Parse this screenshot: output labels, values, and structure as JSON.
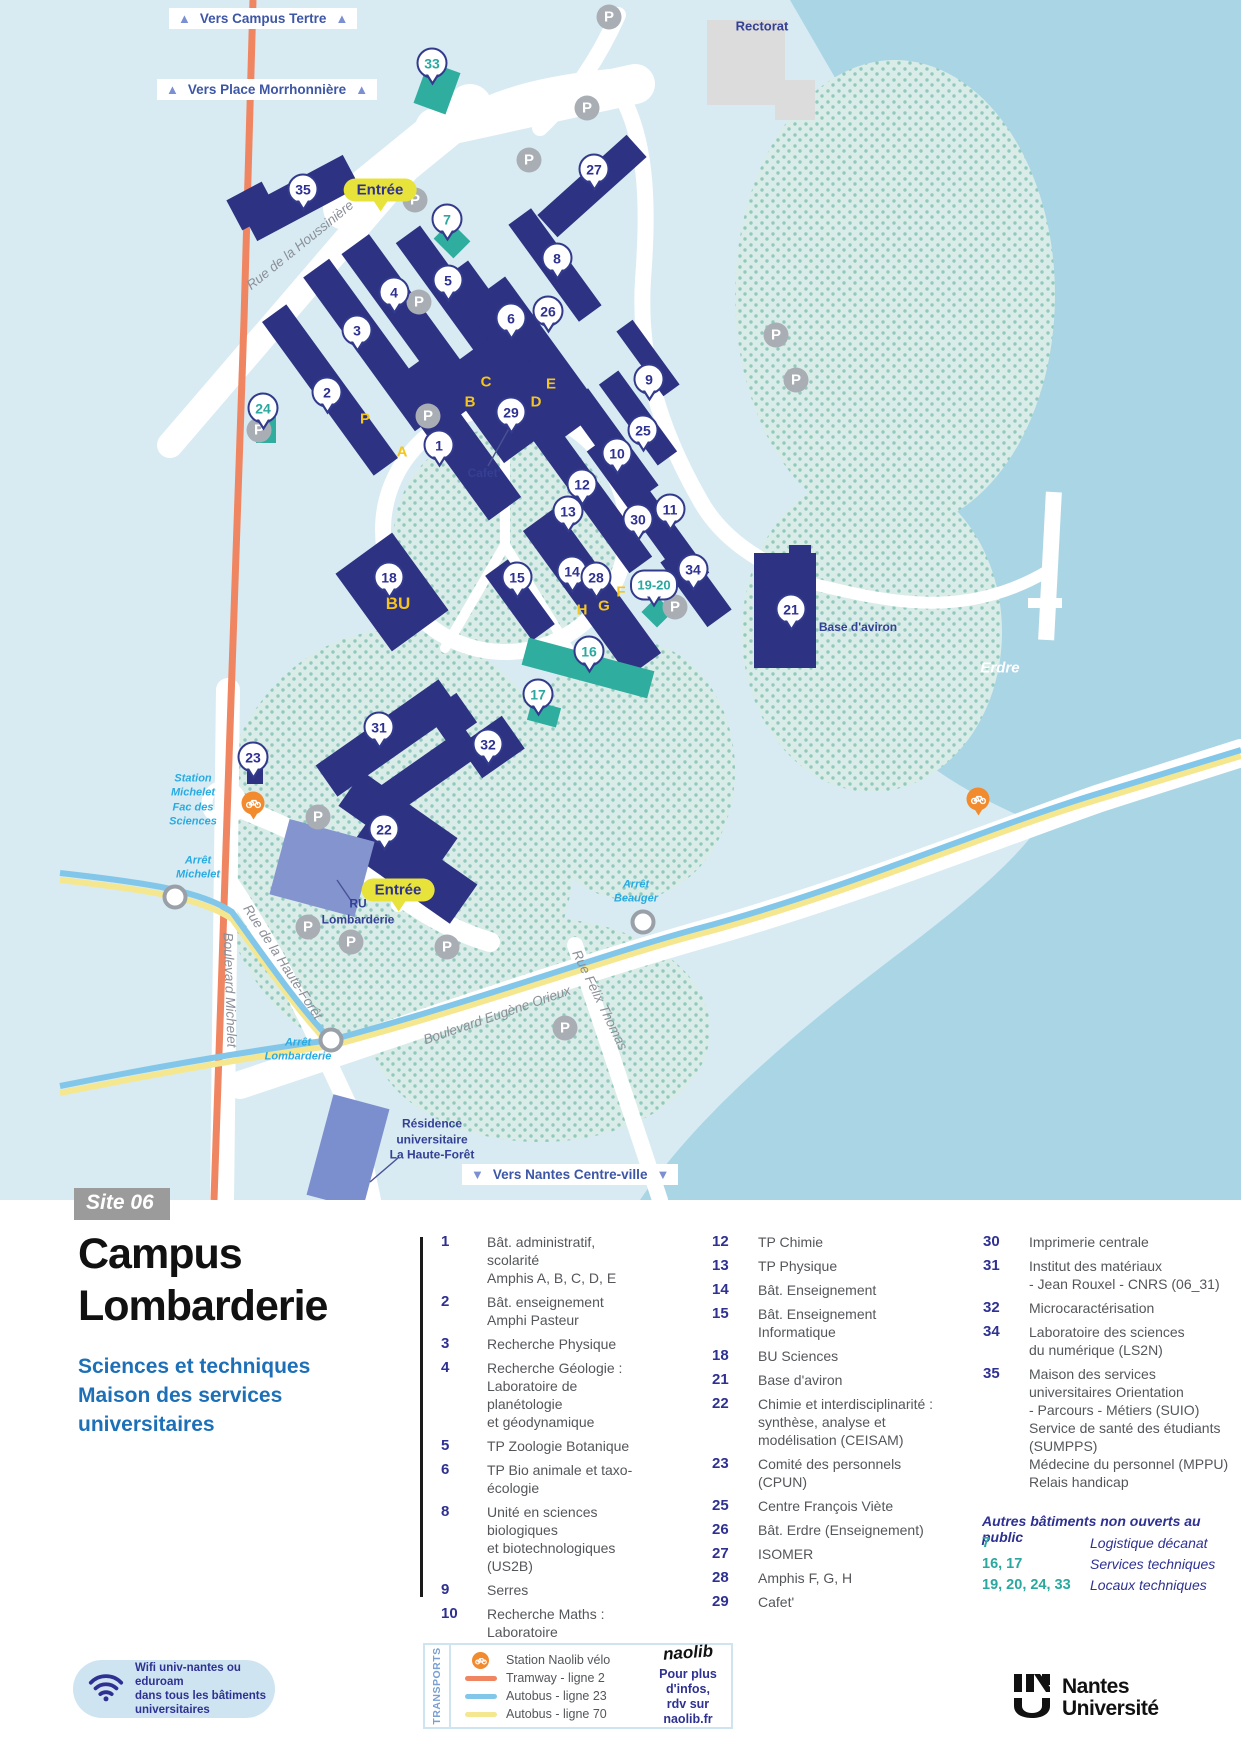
{
  "site_badge": "Site 06",
  "title": "Campus\nLombarderie",
  "subtitle": "Sciences et techniques\nMaison des services\nuniversitaires",
  "icons": {
    "arrow_up": "▲",
    "arrow_down": "▼"
  },
  "map": {
    "entrance_label": "Entrée",
    "directions": {
      "tertre": "Vers Campus Tertre",
      "morrhonniere": "Vers Place Morrhonnière",
      "centreville": "Vers Nantes Centre-ville"
    },
    "labels": {
      "rectorat": "Rectorat",
      "erdre": "Erdre",
      "base_aviron": "Base d'aviron",
      "cafet": "Cafet'",
      "ru": "RU\nLombarderie",
      "bu": "BU",
      "residence": "Résidence\nuniversitaire\nLa Haute-Forêt",
      "station_michelet": "Station\nMichelet\nFac des\nSciences",
      "arret_michelet": "Arrêt\nMichelet",
      "arret_lombarderie": "Arrêt\nLombarderie",
      "arret_beauger": "Arrêt\nBeauger",
      "parking": "P"
    },
    "streets": {
      "houssiniere": "Rue de la Houssinière",
      "michelet": "Boulevard Michelet",
      "haute_foret": "Rue de la Haute-Forêt",
      "orieux": "Boulevard Eugène Orieux",
      "felix_thomas": "Rue Félix Thomas"
    },
    "letters": {
      "a": "A",
      "b": "B",
      "c": "C",
      "d": "D",
      "e": "E",
      "p": "P",
      "f": "F",
      "g": "G",
      "h": "H"
    },
    "markers": {
      "m1": "1",
      "m2": "2",
      "m3": "3",
      "m4": "4",
      "m5": "5",
      "m6": "6",
      "m7": "7",
      "m8": "8",
      "m9": "9",
      "m10": "10",
      "m11": "11",
      "m12": "12",
      "m13": "13",
      "m14": "14",
      "m15": "15",
      "m16": "16",
      "m17": "17",
      "m18": "18",
      "m19_20": "19-20",
      "m21": "21",
      "m22": "22",
      "m23": "23",
      "m24": "24",
      "m25": "25",
      "m26": "26",
      "m27": "27",
      "m28": "28",
      "m29": "29",
      "m30": "30",
      "m31": "31",
      "m32": "32",
      "m33": "33",
      "m34": "34",
      "m35": "35"
    }
  },
  "legend": {
    "col1": [
      {
        "num": "1",
        "text": "Bât. administratif, scolarité\nAmphis A, B, C, D, E"
      },
      {
        "num": "2",
        "text": "Bât. enseignement\nAmphi Pasteur"
      },
      {
        "num": "3",
        "text": "Recherche Physique"
      },
      {
        "num": "4",
        "text": "Recherche Géologie :\nLaboratoire de planétologie\net géodynamique"
      },
      {
        "num": "5",
        "text": "TP Zoologie Botanique"
      },
      {
        "num": "6",
        "text": "TP Bio animale et taxo-écologie"
      },
      {
        "num": "8",
        "text": "Unité en sciences biologiques\net biotechnologiques (US2B)"
      },
      {
        "num": "9",
        "text": "Serres"
      },
      {
        "num": "10",
        "text": "Recherche Maths : Laboratoire\nde mathématiques - Jean Leray"
      },
      {
        "num": "11",
        "text": "Laboratoire des sciences\ndu numérique (LS2N)"
      }
    ],
    "col2": [
      {
        "num": "12",
        "text": "TP Chimie"
      },
      {
        "num": "13",
        "text": "TP Physique"
      },
      {
        "num": "14",
        "text": "Bât. Enseignement"
      },
      {
        "num": "15",
        "text": "Bât. Enseignement\nInformatique"
      },
      {
        "num": "18",
        "text": "BU Sciences"
      },
      {
        "num": "21",
        "text": "Base d'aviron"
      },
      {
        "num": "22",
        "text": "Chimie et interdisciplinarité :\nsynthèse, analyse et\nmodélisation (CEISAM)"
      },
      {
        "num": "23",
        "text": "Comité des personnels (CPUN)"
      },
      {
        "num": "25",
        "text": "Centre François Viète"
      },
      {
        "num": "26",
        "text": "Bât. Erdre (Enseignement)"
      },
      {
        "num": "27",
        "text": "ISOMER"
      },
      {
        "num": "28",
        "text": "Amphis F, G, H"
      },
      {
        "num": "29",
        "text": "Cafet'"
      }
    ],
    "col3": [
      {
        "num": "30",
        "text": "Imprimerie centrale"
      },
      {
        "num": "31",
        "text": "Institut des matériaux\n- Jean Rouxel - CNRS (06_31)"
      },
      {
        "num": "32",
        "text": "Microcaractérisation"
      },
      {
        "num": "34",
        "text": "Laboratoire des sciences\ndu numérique (LS2N)"
      },
      {
        "num": "35",
        "text": "Maison des services\nuniversitaires Orientation\n- Parcours - Métiers (SUIO)\nService de santé des étudiants\n(SUMPPS)\nMédecine du personnel (MPPU)\nRelais handicap"
      }
    ],
    "other": {
      "title": "Autres bâtiments non ouverts au public",
      "rows": [
        {
          "nums": "7",
          "label": "Logistique décanat"
        },
        {
          "nums": "16, 17",
          "label": "Services techniques"
        },
        {
          "nums": "19, 20, 24, 33",
          "label": "Locaux techniques"
        }
      ]
    }
  },
  "wifi": {
    "text": "Wifi univ-nantes ou eduroam\ndans tous les bâtiments\nuniversitaires"
  },
  "transports": {
    "title": "TRANSPORTS",
    "items": [
      {
        "label": "Station Naolib vélo"
      },
      {
        "label": "Tramway - ligne 2"
      },
      {
        "label": "Autobus - ligne 23"
      },
      {
        "label": "Autobus - ligne 70"
      }
    ],
    "naolib": "naolib",
    "info": "Pour plus d'infos,\nrdv sur naolib.fr"
  },
  "brand": {
    "name": "Nantes\nUniversité"
  },
  "colors": {
    "building": "#2d3282",
    "technical": "#2fae9f",
    "water": "#aad5e5",
    "tram": "#ef8661",
    "bus23": "#82c7e9",
    "bus70": "#f5e78f",
    "entrance": "#e7e33b",
    "transit": "#29abe2"
  }
}
